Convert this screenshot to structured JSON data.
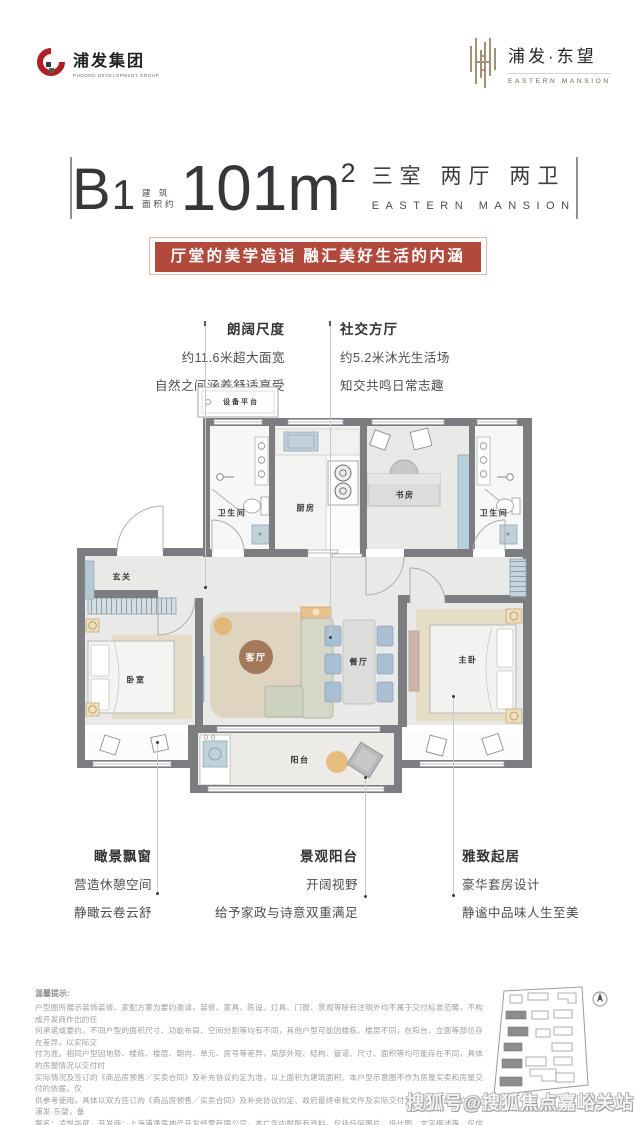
{
  "header": {
    "left_logo": {
      "name": "浦发集团",
      "subtitle": "PUDONG DEVELOPMENT GROUP",
      "brand_red": "#b01f24"
    },
    "right_logo": {
      "name": "浦发·东望",
      "subtitle": "EASTERN MANSION",
      "brand_gold": "#a39077"
    }
  },
  "title": {
    "unit": "B",
    "unit_num": "1",
    "area_prefix_line1": "建 筑",
    "area_prefix_line2": "面积约",
    "area_value": "101m",
    "area_sup": "2",
    "layout_cn": "三室 两厅 两卫",
    "layout_en": "EASTERN MANSION"
  },
  "banner": {
    "text": "厅堂的美学造诣 融汇美好生活的内涵",
    "bg": "#b1493d"
  },
  "callouts": {
    "top_left": {
      "title": "朗阔尺度",
      "line1": "约11.6米超大面宽",
      "line2": "自然之间涵养舒适享受"
    },
    "top_right": {
      "title": "社交方厅",
      "line1": "约5.2米沐光生活场",
      "line2": "知交共鸣日常志趣"
    },
    "bottom_left": {
      "title": "瞰景飘窗",
      "line1": "营造休憩空间",
      "line2": "静瞰云卷云舒"
    },
    "bottom_mid": {
      "title": "景观阳台",
      "line1": "开阔视野",
      "line2": "给予家政与诗意双重满足"
    },
    "bottom_right": {
      "title": "雅致起居",
      "line1": "豪华套房设计",
      "line2": "静谧中品味人生至美"
    }
  },
  "floorplan": {
    "wall_color": "#7b7d80",
    "accent_blue": "#b5c8d3",
    "rug_tan": "#ded4bf",
    "living_circle_brown": "#a3795a",
    "rooms": {
      "equipment_platform": "设备平台",
      "bathroom_left": "卫生间",
      "kitchen": "厨房",
      "study": "书房",
      "bathroom_right": "卫生间",
      "foyer": "玄关",
      "bedroom": "卧室",
      "living_room": "客厅",
      "dining_room": "餐厅",
      "master_bedroom": "主卧",
      "balcony": "阳台"
    }
  },
  "disclaimer": {
    "title": "温馨提示:",
    "lines": [
      "户型图所展示装饰装修、家配方案为要约邀请，装修、家具、陈设、灯具、门窗、景观等除有注明外均不属于交付标准范畴，不构成开发商作出的任",
      "何承诺或要约。不同户型的面积尺寸、功能布局、空间分割等均有不同，其他户型可能因楼栋、楼层不同，在阳台、立面等部位存在差异，以实际交",
      "付为准。相同户型因地势、楼栋、楼层、朝向、单元、房号等差异，局部外观、结构、管道、尺寸、面积等均可能存在不同，具体的房屋情况以交付时",
      "实际情况及签订的《商品房预售／买卖合同》及补充协议约定为准，以上面积为建筑面积。本户型示意图不作为房屋买卖和房屋交付的依据，仅",
      "供参考使用，具体以双方签订的《商品房预售／买卖合同》及补充协议约定、政府最终审批文件及实际交付为准。本项目推广名：浦发·东望，备",
      "案名：凌悦华庭，开发商：上海浦逸房地产开发经营有限公司。本广告内附所有资料，包括任何图片、设计图、文字描述等，仅供参考识别之用，",
      "不构成合同内容，具体权利义务以双方签署的销售合同内容及政府最终审批为准。本宣传资料制作时间为 2023 年 08 月，本公司保留对其进行",
      "变更或更改的权利，如有更新，恕不另行通知，请以最终资料为准。"
    ]
  },
  "watermark": {
    "text": "搜狐号@搜狐焦点嘉峪关站"
  }
}
